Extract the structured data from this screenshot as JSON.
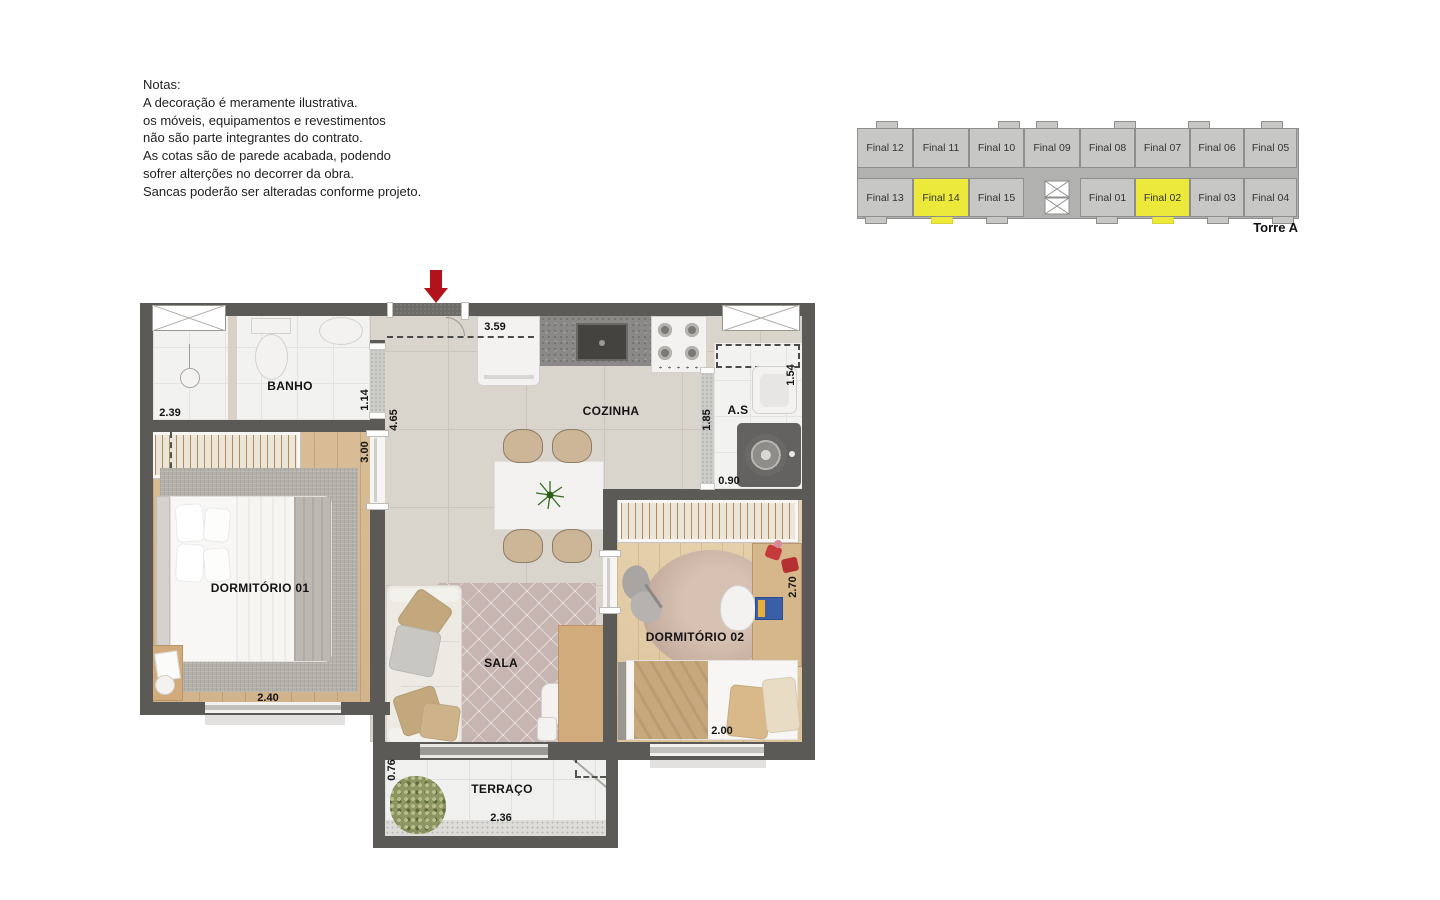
{
  "notes": {
    "lines": [
      "Notas:",
      "A decoração é meramente ilustrativa.",
      "os móveis, equipamentos e revestimentos",
      "não são parte integrantes do contrato.",
      "As cotas são de parede acabada, podendo",
      "sofrer alterções no decorrer da obra.",
      "Sancas poderão ser alteradas conforme projeto."
    ]
  },
  "keyplan": {
    "torre": "Torre A",
    "units_top": [
      "Final 12",
      "Final 11",
      "Final 10",
      "Final 09",
      "Final 08",
      "Final 07",
      "Final 06",
      "Final 05"
    ],
    "units_bottom": [
      "Final 13",
      "Final 14",
      "Final 15",
      "Final 01",
      "Final 02",
      "Final 03",
      "Final 04"
    ],
    "highlighted_units": [
      "Final 14",
      "Final 02"
    ],
    "colors": {
      "unit": "#c7c7c5",
      "highlight": "#ece93a",
      "corridor": "#b1b1af",
      "outline": "#8e8e8c"
    }
  },
  "plan": {
    "rooms": {
      "banho": "BANHO",
      "cozinha": "COZINHA",
      "as": "A.S",
      "dorm01": "DORMITÓRIO 01",
      "sala": "SALA",
      "dorm02": "DORMITÓRIO 02",
      "terraco": "TERRAÇO"
    },
    "dims": {
      "banho_width": "2.39",
      "cozinha_width": "3.59",
      "porta_vidro": "1.14",
      "circulacao": "4.65",
      "dorm01_depth": "3.00",
      "as_depth": "1.85",
      "as_top": "1.54",
      "as_width": "0.90",
      "dorm01_width": "2.40",
      "dorm02_depth": "2.70",
      "dorm02_width": "2.00",
      "terraco_depth": "0.76",
      "terraco_width": "2.36"
    },
    "colors": {
      "wall": "#5c5a57",
      "entry_arrow": "#b2121a",
      "wood": "#d5ba94",
      "tile": "#d9d4cc"
    }
  }
}
